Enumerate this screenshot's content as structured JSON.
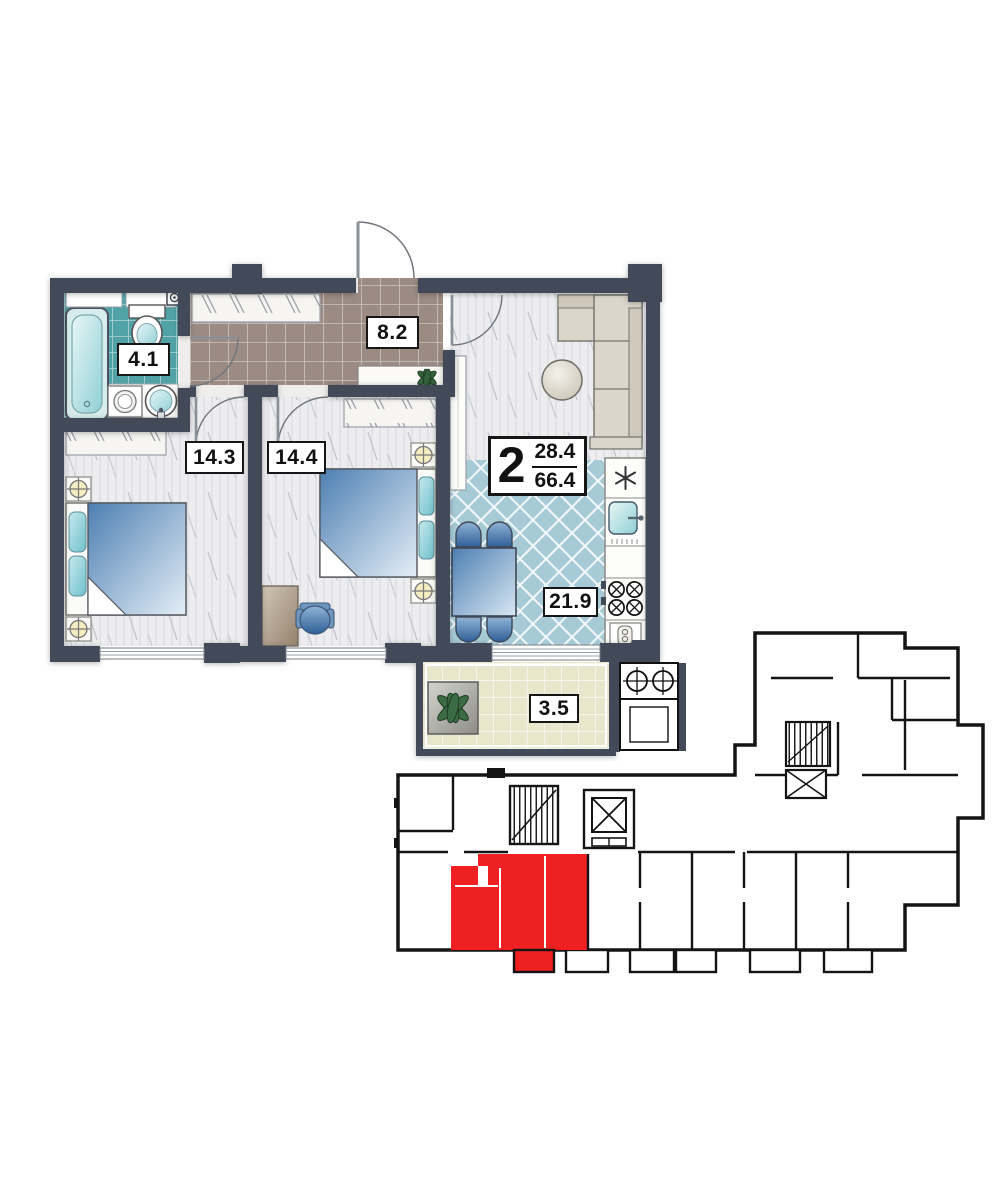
{
  "floor_plan": {
    "apartment_label": {
      "rooms_count": "2",
      "upper_area": "28.4",
      "lower_area": "66.4"
    },
    "rooms": [
      {
        "name": "bathroom",
        "area_label": "4.1"
      },
      {
        "name": "hallway",
        "area_label": "8.2"
      },
      {
        "name": "bedroom-1",
        "area_label": "14.3"
      },
      {
        "name": "bedroom-2",
        "area_label": "14.4"
      },
      {
        "name": "kitchen-living-room",
        "area_label": "21.9"
      },
      {
        "name": "balcony",
        "area_label": "3.5"
      }
    ],
    "colors": {
      "wall": "#424959",
      "bathroom_tile": "#51a2a6",
      "hallway_tile": "#9b8b83",
      "kitchen_tile": "#a6cbd7",
      "balcony_tile": "#e9e7cb",
      "room_floor": "#ededf0",
      "highlight_red": "#ee2022"
    }
  },
  "key_plan": {
    "highlighted_unit_color": "#ee2022"
  }
}
